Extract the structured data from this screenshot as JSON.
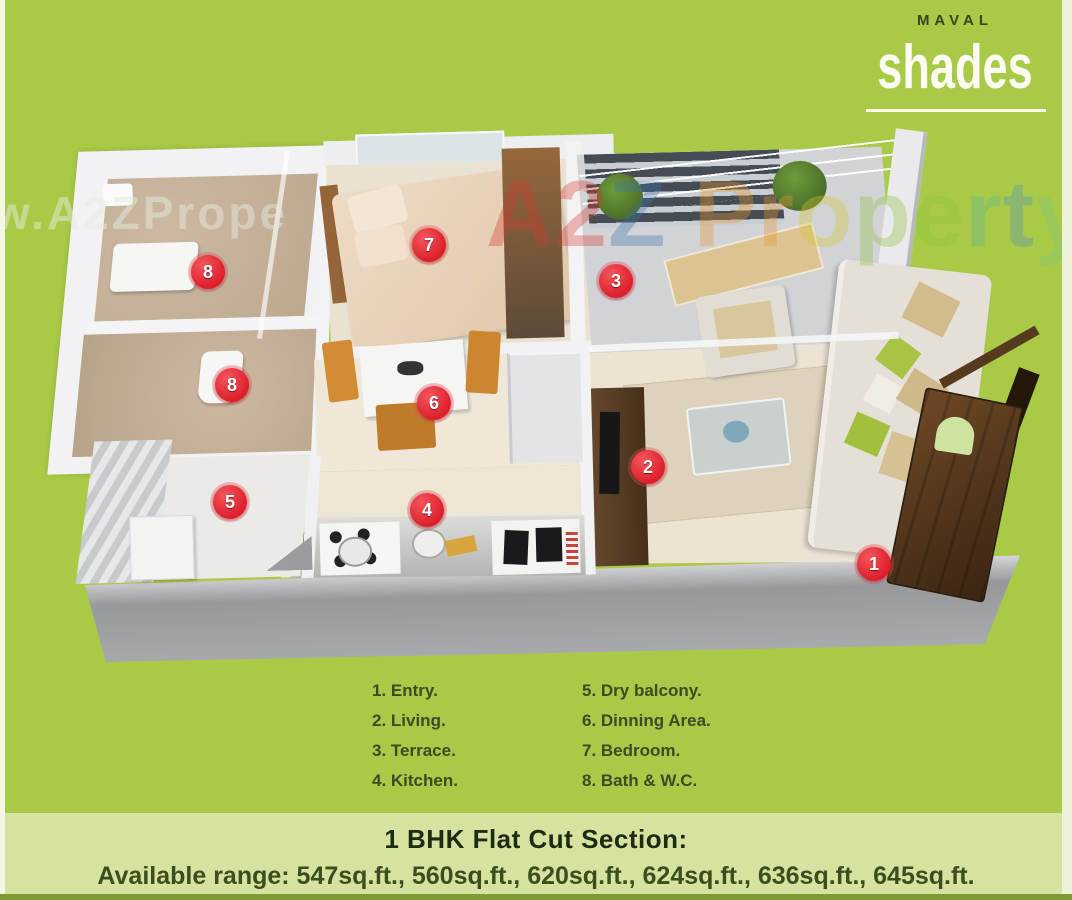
{
  "brand": {
    "name_top": "MAVAL",
    "name_main": "shades"
  },
  "watermarks": {
    "gray_text": "w.A2ZPrope",
    "colored_letters": [
      {
        "ch": "A",
        "color": "#d63a2f"
      },
      {
        "ch": "2",
        "color": "#d63a2f"
      },
      {
        "ch": "Z",
        "color": "#3f74ae"
      },
      {
        "ch": " ",
        "color": "transparent"
      },
      {
        "ch": "P",
        "color": "#e8972e"
      },
      {
        "ch": "r",
        "color": "#e8972e"
      },
      {
        "ch": "o",
        "color": "#d8c832"
      },
      {
        "ch": "p",
        "color": "#8fc43c"
      },
      {
        "ch": "e",
        "color": "#8fc43c"
      },
      {
        "ch": "r",
        "color": "#5bb0a0"
      },
      {
        "ch": "t",
        "color": "#4f92c8"
      },
      {
        "ch": "y",
        "color": "#7fc480"
      }
    ]
  },
  "plan_markers": [
    {
      "num": "1",
      "label": "Entry",
      "x": 844,
      "y": 446
    },
    {
      "num": "2",
      "label": "Living",
      "x": 618,
      "y": 349
    },
    {
      "num": "3",
      "label": "Terrace",
      "x": 586,
      "y": 163
    },
    {
      "num": "4",
      "label": "Kitchen",
      "x": 397,
      "y": 392
    },
    {
      "num": "5",
      "label": "Dry balcony",
      "x": 200,
      "y": 384
    },
    {
      "num": "6",
      "label": "Dinning Area",
      "x": 404,
      "y": 285
    },
    {
      "num": "7",
      "label": "Bedroom",
      "x": 399,
      "y": 127
    },
    {
      "num": "8",
      "label": "Bath & W.C",
      "x": 178,
      "y": 154
    },
    {
      "num": "8",
      "label": "Bath & W.C",
      "x": 202,
      "y": 267
    }
  ],
  "legend": {
    "col1": [
      "1. Entry.",
      "2. Living.",
      "3. Terrace.",
      "4. Kitchen."
    ],
    "col2": [
      "5. Dry balcony.",
      "6. Dinning Area.",
      "7. Bedroom.",
      "8. Bath & W.C."
    ]
  },
  "footer": {
    "title": "1 BHK Flat Cut Section:",
    "range": "Available range: 547sq.ft., 560sq.ft., 620sq.ft., 624sq.ft., 636sq.ft., 645sq.ft."
  },
  "colors": {
    "brand_green": "#a9ca46",
    "footer_strip": "#d6e2a0",
    "marker_red": "#dd1f2b",
    "legend_text": "#3d4a24"
  }
}
